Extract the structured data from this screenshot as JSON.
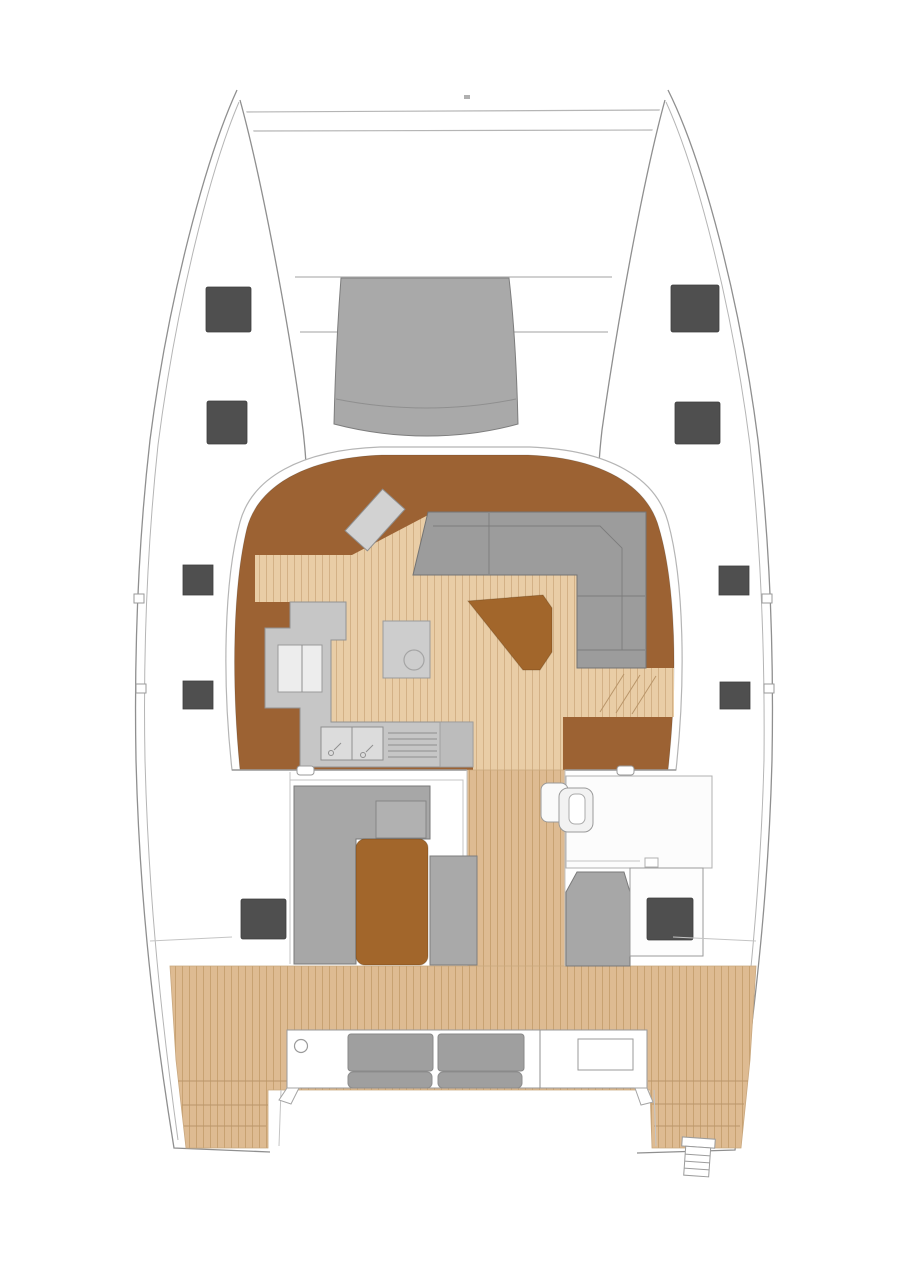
{
  "title": "Catamaran main-deck floor plan",
  "view": "top-down naval architecture layout drawing, no text labels visible",
  "palette": {
    "background": "#ffffff",
    "hull_outline": "#8f8f8f",
    "outline_soft": "#b5b5b5",
    "hatch_dark": "#4f4f4f",
    "foredeck_gray": "#a9a9a9",
    "saloon_brown": "#9c6233",
    "furniture_brown": "#a2662b",
    "saloon_teak": "#e9cda6",
    "saloon_teak_line": "#d3b186",
    "cockpit_teak": "#debb92",
    "cockpit_teak_line": "#c8a272",
    "sofa_gray": "#9c9c9c",
    "counter_gray": "#c6c6c6",
    "island_gray": "#cdcdcd"
  },
  "areas": {
    "bow": "twin hull bows with crossbeam lines and anchor fitting dot",
    "foredeck_pod": "gray forward coachroof / windshield pod",
    "saloon": "dark wood saloon with teak plank floor",
    "dinette": "C-shaped gray settee, starboard aft corner of saloon",
    "nav_table": "angled chart table, port forward in saloon",
    "cocktail_table": "brown wedge table beside settee",
    "galley": "port galley counters with fridge cabinet, twin sink and stove grill",
    "island_unit": "small freestanding island with round basin",
    "companionways": "stair treads down to each hull",
    "aft_cabins_band": "port lounge berth and starboard helm/heads modules",
    "cockpit": "teak cockpit with aft bench, two cushion pairs and side tables",
    "transoms": "teak transom steps on both hulls, swim ladder starboard",
    "hatches": "dark deck hatches: 2 per bow, 2 per mid hull, 2 in aft band"
  },
  "counts": {
    "bow_hatches": 4,
    "mid_hull_hatches": 4,
    "aft_hatches": 2,
    "bench_cushions": 4
  }
}
